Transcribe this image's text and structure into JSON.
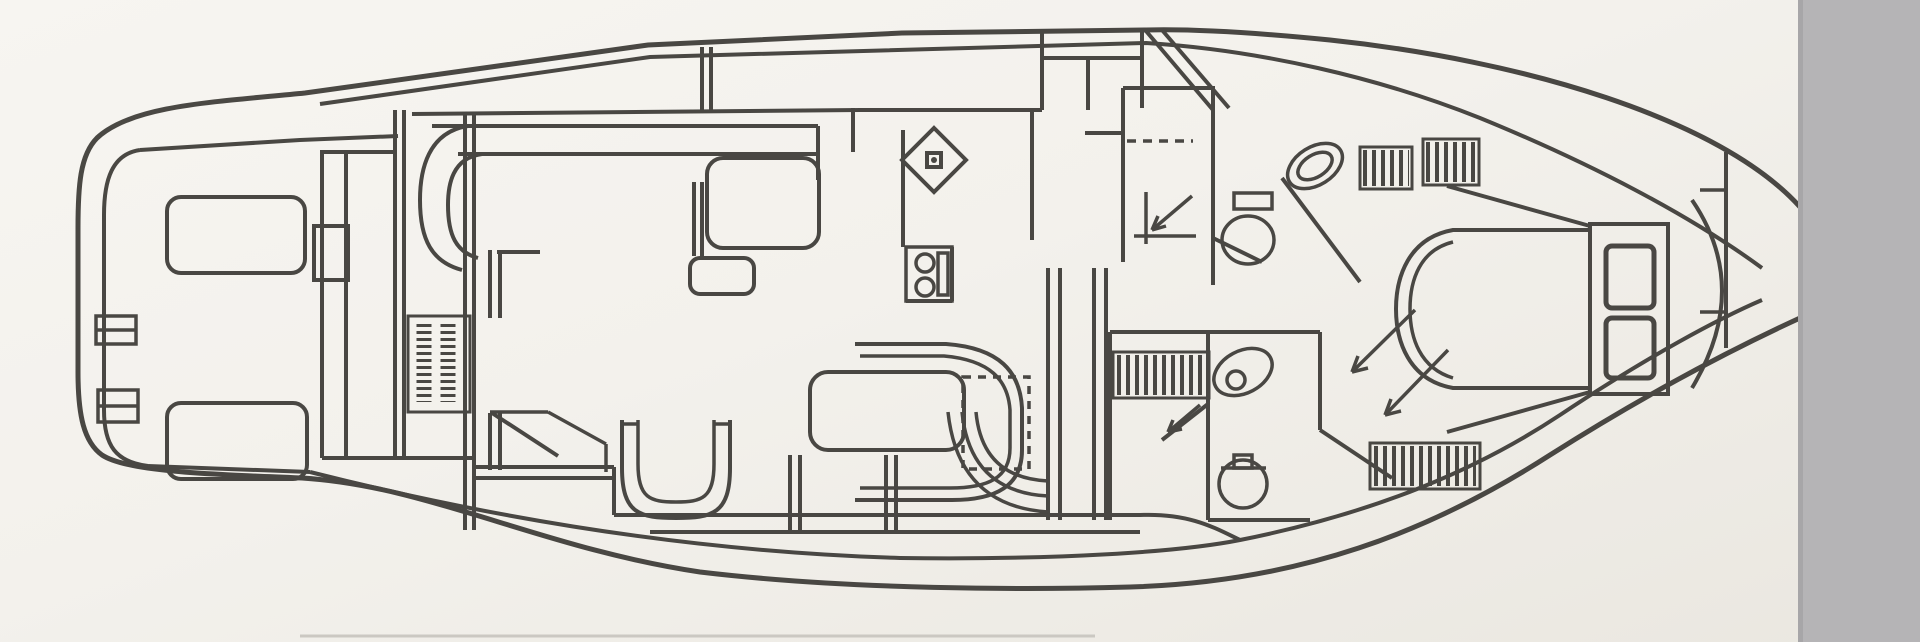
{
  "image": {
    "width": 1920,
    "height": 642,
    "kind": "scanned black-and-white line drawing, interior deck plan of a motor yacht, bow pointing right, scan cropped by a gray band on the right edge"
  },
  "colors": {
    "paper": "#f3f1ec",
    "paper_light": "#f7f5f1",
    "paper_dark": "#eae7e0",
    "ink": "#3d3b37",
    "scanner_band": "#b5b4b6",
    "scanner_band_edge": "#a7a6a8",
    "artifact_line": "#cbc8c2"
  },
  "labels": {
    "vertical_text_block": {
      "content": "",
      "legible": false,
      "note_shape": "two short columns of tiny rotated print on the aft bulkhead, too blurred to read"
    }
  },
  "regions": [
    {
      "id": "hull-outline"
    },
    {
      "id": "aft-deck",
      "features": [
        "deck-hatch",
        "deck-hatch",
        "boarding-steps",
        "flybridge-ladder",
        "panel-box"
      ]
    },
    {
      "id": "salon",
      "features": [
        "sofa",
        "salon-table",
        "ottoman",
        "sliding-door",
        "illegible-vertical-text-block"
      ]
    },
    {
      "id": "galley",
      "features": [
        "corner-sink",
        "two-burner-stove",
        "counter"
      ]
    },
    {
      "id": "upper-head",
      "features": [
        "shower-drain-arrow",
        "toilet",
        "wash-basin"
      ]
    },
    {
      "id": "companionway",
      "features": [
        "dashed-overhead-line",
        "curved-steps",
        "corridor-walls"
      ]
    },
    {
      "id": "dinette",
      "features": [
        "table",
        "curved-bench"
      ]
    },
    {
      "id": "helm-seat"
    },
    {
      "id": "lower-head",
      "features": [
        "wash-basin",
        "toilet",
        "door-swing-arrow"
      ]
    },
    {
      "id": "hanging-lockers",
      "count": 4
    },
    {
      "id": "forward-stateroom",
      "features": [
        "island-berth",
        "headboard-steps",
        "bow-bulkhead-arc"
      ]
    },
    {
      "id": "scanner-gray-band"
    }
  ]
}
